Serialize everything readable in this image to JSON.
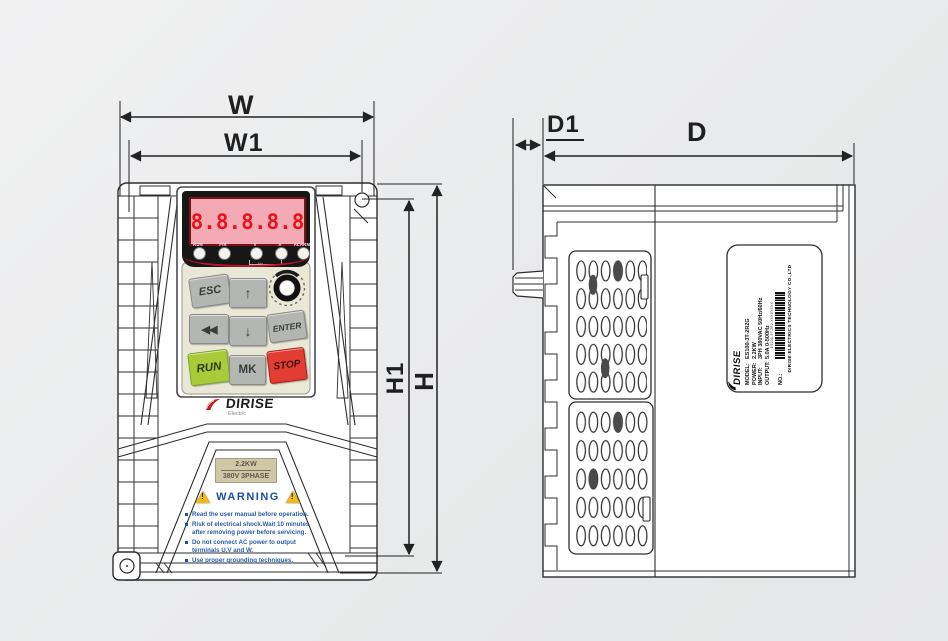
{
  "colors": {
    "line_dark": "#2e2e2e",
    "accent_red": "#c8102e",
    "display_bg": "#f4aab5",
    "digit_red": "#e8131c",
    "keypad_beige": "#e9e7d5",
    "button_gray": "#b4b6b3",
    "run_green": "#a8cb39",
    "stop_red": "#e23c33",
    "warning_blue": "#1e4ea2",
    "warning_yellow": "#f5b80c",
    "power_label_tan": "#cfc8a6"
  },
  "dimensions": {
    "width": "W",
    "width_inner": "W1",
    "height": "H",
    "height_inner": "H1",
    "depth": "D",
    "depth_knob": "D1"
  },
  "front_view": {
    "display_value": "8.8.8.8.8",
    "led_labels": [
      "RUN",
      "F/R",
      "V",
      "A",
      "ALARM"
    ],
    "led_bracket_label": "Hz",
    "buttons": {
      "esc": "ESC",
      "up": "↑",
      "back": "◀◀",
      "down": "↓",
      "enter": "ENTER",
      "run": "RUN",
      "mk": "MK",
      "stop": "STOP"
    },
    "brand": {
      "name": "DIRISE",
      "sub": "Electric"
    },
    "power_label": {
      "line1": "2.2KW",
      "line2": "380V 3PHASE"
    },
    "warning": {
      "title": "WARNING",
      "triangle_mark": "!",
      "items": [
        "Read the user manual before operation.",
        "Risk of electrical shock.Wait 10 minutes\nafter removing power before servicing.",
        "Do not connect AC power to output\nterminals U,V and W.",
        "Use proper grounding techniques."
      ]
    }
  },
  "side_view": {
    "nameplate": {
      "brand": "DIRISE",
      "fields": [
        {
          "label": "MODEL:",
          "value": "ES100-3T-2R2G"
        },
        {
          "label": "POWER:",
          "value": "2.2KW"
        },
        {
          "label": "INPUT:",
          "value": "3PH 380VAC 50Hz/60Hz"
        },
        {
          "label": "OUTPUT:",
          "value": "5.0A 0-500Hz"
        },
        {
          "label": "NO.:",
          "value": ""
        }
      ],
      "barcode_text": "ES100-3T-2R2-XXXXXXXX",
      "company": "DIRISE ELECTRICS TECHNOLOGY CO.,LTD"
    }
  }
}
